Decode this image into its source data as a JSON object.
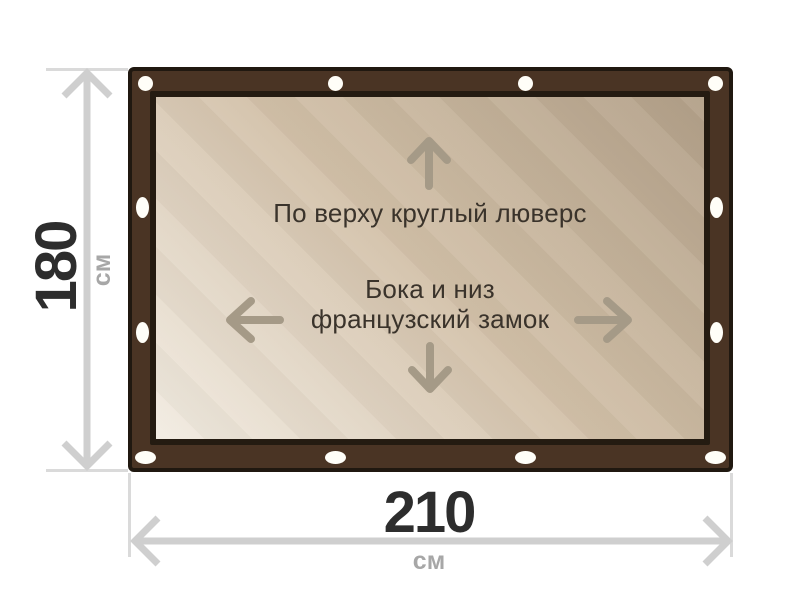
{
  "diagram": {
    "annotations": {
      "top": "По верху круглый люверс",
      "center_line1": "Бока и низ",
      "center_line2": "французский замок"
    },
    "dimensions": {
      "height": {
        "value": "180",
        "unit": "см"
      },
      "width": {
        "value": "210",
        "unit": "см"
      }
    },
    "icons": {
      "panel": [
        "arrow-up-icon",
        "arrow-left-icon",
        "arrow-right-icon",
        "arrow-down-icon"
      ],
      "dimension": [
        "double-arrow-vertical-icon",
        "double-arrow-horizontal-icon"
      ],
      "fasteners": [
        "round-grommet-icon",
        "slot-grommet-icon"
      ]
    }
  },
  "colors": {
    "background": "#ffffff",
    "frame_brown": "#4a3424",
    "frame_outline": "#201810",
    "panel_border": "#241b11",
    "panel_light": "#f2ece2",
    "panel_mid": "#d2c0a8",
    "panel_dark": "#b2a088",
    "grommet_white": "#fffef8",
    "panel_arrow": "#a59a87",
    "dim_line": "#cfcfcf",
    "ext_line": "#dadada",
    "dim_text": "#2d2d2d",
    "unit_text": "#a7a7a7",
    "note_text": "#3a332b"
  }
}
